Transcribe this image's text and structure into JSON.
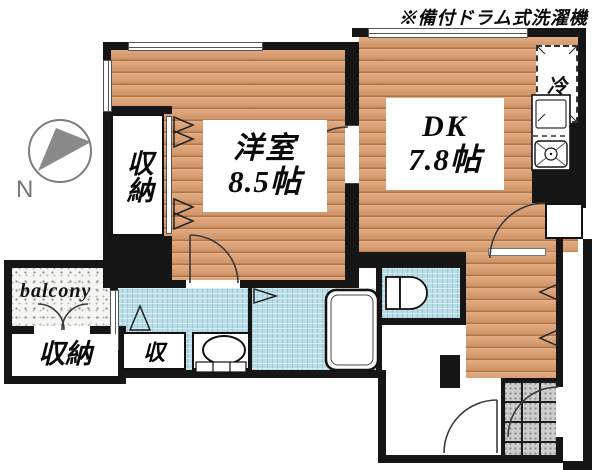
{
  "note": "※備付ドラム式洗濯機",
  "compass": {
    "north_label": "N"
  },
  "rooms": {
    "western_room": {
      "name": "洋室",
      "size": "8.5帖"
    },
    "dining_kitchen": {
      "name": "DK",
      "size": "7.8帖"
    },
    "closet_upper": {
      "name": "収納"
    },
    "storage_room": {
      "name": "収納"
    },
    "hall_closet": {
      "name": "収"
    },
    "balcony": {
      "name": "balcony"
    },
    "refrigerator": {
      "name": "冷"
    }
  },
  "colors": {
    "wall": "#161616",
    "wood_floor": "#d9a076",
    "wet_area": "#b9dde6",
    "entrance_tile": "#cdcdcd",
    "compass_gray": "#808080"
  }
}
